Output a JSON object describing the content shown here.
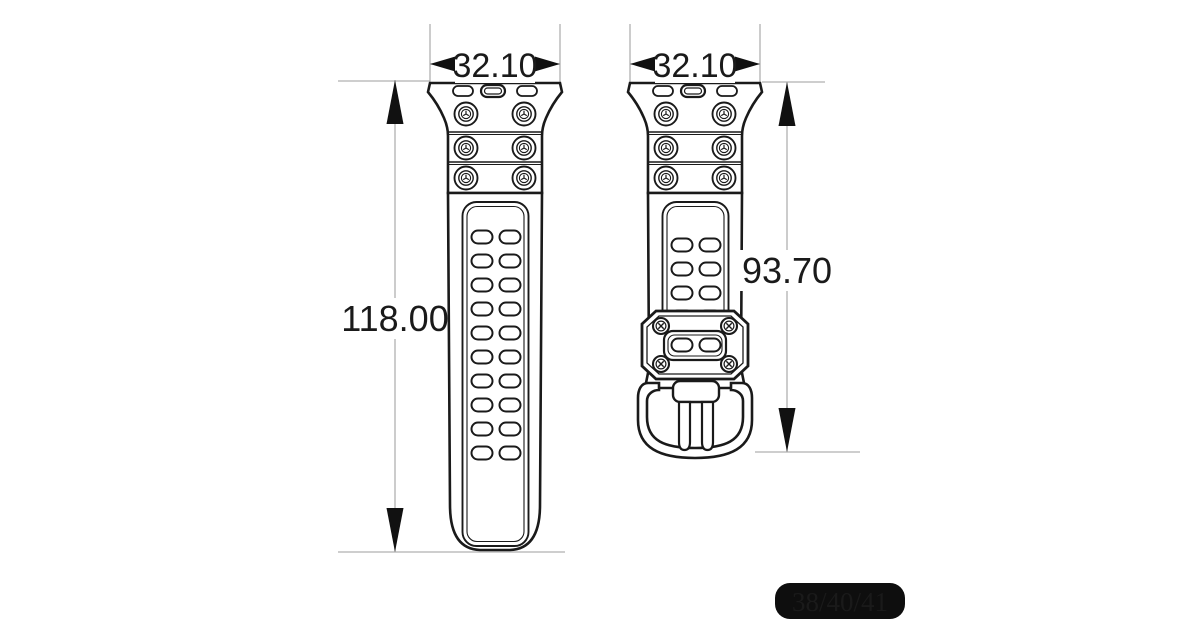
{
  "diagram": {
    "views": {
      "left": {
        "width_label": "32.10",
        "length_label": "118.00"
      },
      "right": {
        "width_label": "32.10",
        "length_label": "93.70"
      }
    },
    "size_badge": "38/40/41",
    "colors": {
      "line": "#1a1a1a",
      "dim_line": "#b0b0b0",
      "dim_text": "#1a1a1a",
      "badge_bg": "#0e0e0e",
      "badge_text": "#ffffff"
    }
  }
}
